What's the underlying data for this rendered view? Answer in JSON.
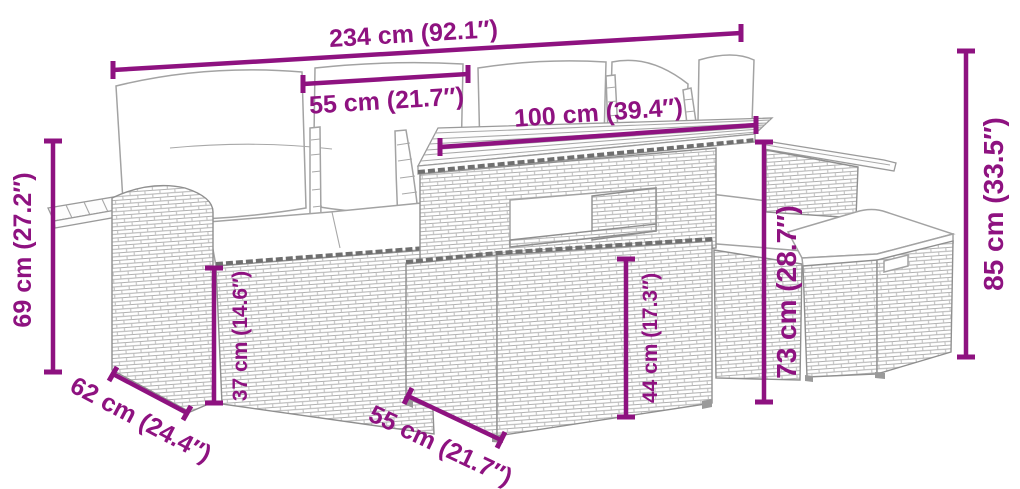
{
  "diagram": {
    "title": "garden-furniture-set-dimension-diagram",
    "subject": "rattan lounge set with sofa, table and ottomans",
    "colors": {
      "dimension": "#8e1280",
      "line_art": "#9a9a9a"
    },
    "dims": {
      "overall_width": "234 cm (92.1″)",
      "backrest_section_width": "55 cm (21.7″)",
      "table_top_width": "100 cm (39.4″)",
      "armrest_height": "69 cm (27.2″)",
      "armrest_depth": "62 cm (24.4″)",
      "seat_height": "37 cm (14.6″)",
      "table_depth": "55 cm (21.7″)",
      "table_lower_height": "44 cm (17.3″)",
      "backrest_height": "73 cm (28.7″)",
      "overall_height": "85 cm (33.5″)"
    }
  }
}
